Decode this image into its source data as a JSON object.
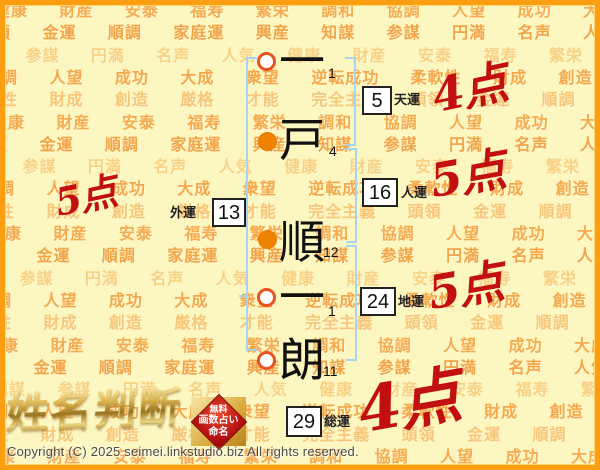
{
  "page": {
    "copyright": "Copyright (C) 2025 seimei.linkstudio.biz All rights reserved."
  },
  "logo": {
    "title": "姓名判断",
    "badge_lines": [
      "無料",
      "画数占い",
      "命名"
    ]
  },
  "name_chart": {
    "characters": [
      {
        "char": "一",
        "strokes": "1",
        "marker": "open"
      },
      {
        "char": "戸",
        "strokes": "4",
        "marker": "filled"
      },
      {
        "char": "順",
        "strokes": "12",
        "marker": "filled"
      },
      {
        "char": "一",
        "strokes": "1",
        "marker": "open"
      },
      {
        "char": "朗",
        "strokes": "11",
        "marker": "open"
      }
    ],
    "fortunes": [
      {
        "id": "tenun",
        "value": "5",
        "label": "天運",
        "score": "4点"
      },
      {
        "id": "jinun",
        "value": "16",
        "label": "人運",
        "score": "5点"
      },
      {
        "id": "gaiun",
        "value": "13",
        "label": "外運",
        "score": "5点"
      },
      {
        "id": "chiun",
        "value": "24",
        "label": "地運",
        "score": "5点"
      },
      {
        "id": "souun",
        "value": "29",
        "label": "総運",
        "score": "4点"
      }
    ]
  },
  "background_words": [
    "健康",
    "財産",
    "安泰",
    "福寿",
    "繁栄",
    "調和",
    "協調",
    "人望",
    "成功",
    "大成",
    "衆望",
    "逆転成功",
    "柔軟性",
    "財成",
    "創造",
    "厳格",
    "才能",
    "完全主義",
    "頭領",
    "金運",
    "順調",
    "家庭運",
    "興産",
    "知謀",
    "参謀",
    "円満",
    "名声",
    "人気"
  ],
  "colors": {
    "background": "#fcf6c0",
    "frame_orange": "#fb9e12",
    "bracket_blue": "#a5d5f2",
    "score_red": "#c21010",
    "circle_open_ring": "#e8531f",
    "circle_filled": "#ef8200",
    "logo_gold": "#c89b2e",
    "word_shades": [
      "#f5ab50",
      "#f2a448",
      "#f8d284",
      "#f4a84c",
      "#f7c678"
    ]
  }
}
